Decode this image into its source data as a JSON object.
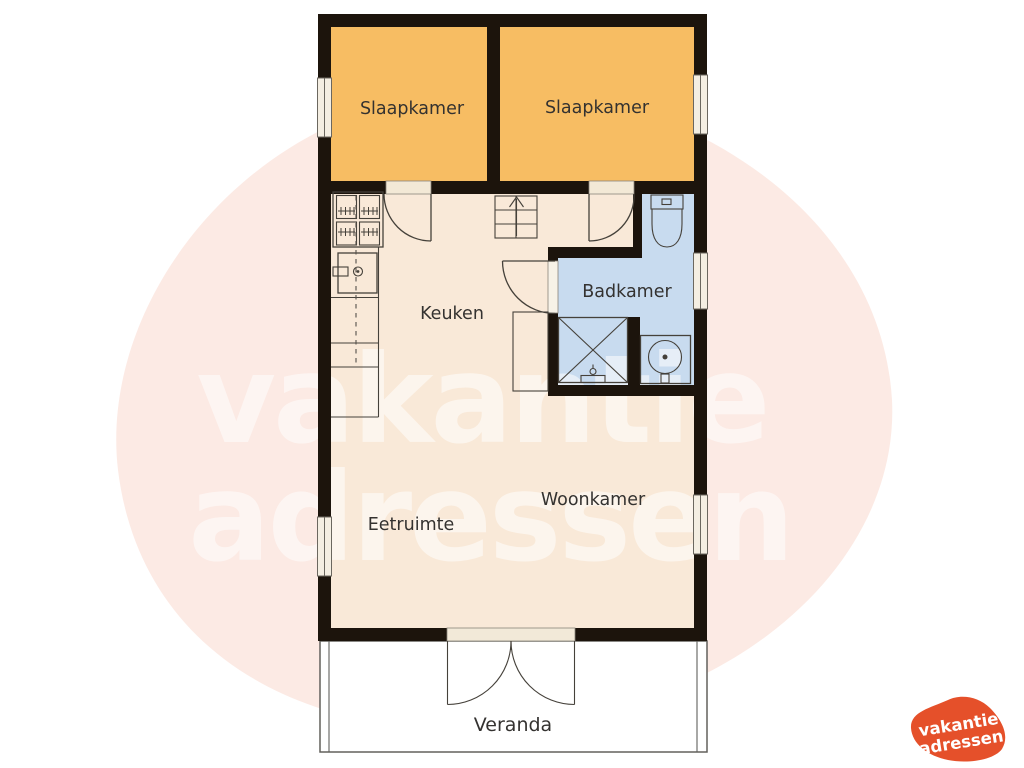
{
  "rooms": {
    "bedroom1": "Slaapkamer",
    "bedroom2": "Slaapkamer",
    "kitchen": "Keuken",
    "bathroom": "Badkamer",
    "living": "Woonkamer",
    "dining": "Eetruimte",
    "veranda": "Veranda"
  },
  "watermark": {
    "line1": "vakantie",
    "line2": "adressen"
  },
  "logo": {
    "line1": "vakantie",
    "line2": "adressen"
  },
  "colors": {
    "bedroom_fill": "#f7bd63",
    "floor_fill": "#f9e9d8",
    "bathroom_fill": "#c8dbef",
    "wall": "#1c140c",
    "logo_orange": "#e5502a",
    "watermark_pink": "#f3b49f",
    "window_fill": "#f4eee2",
    "veranda_fill": "#ffffff"
  }
}
